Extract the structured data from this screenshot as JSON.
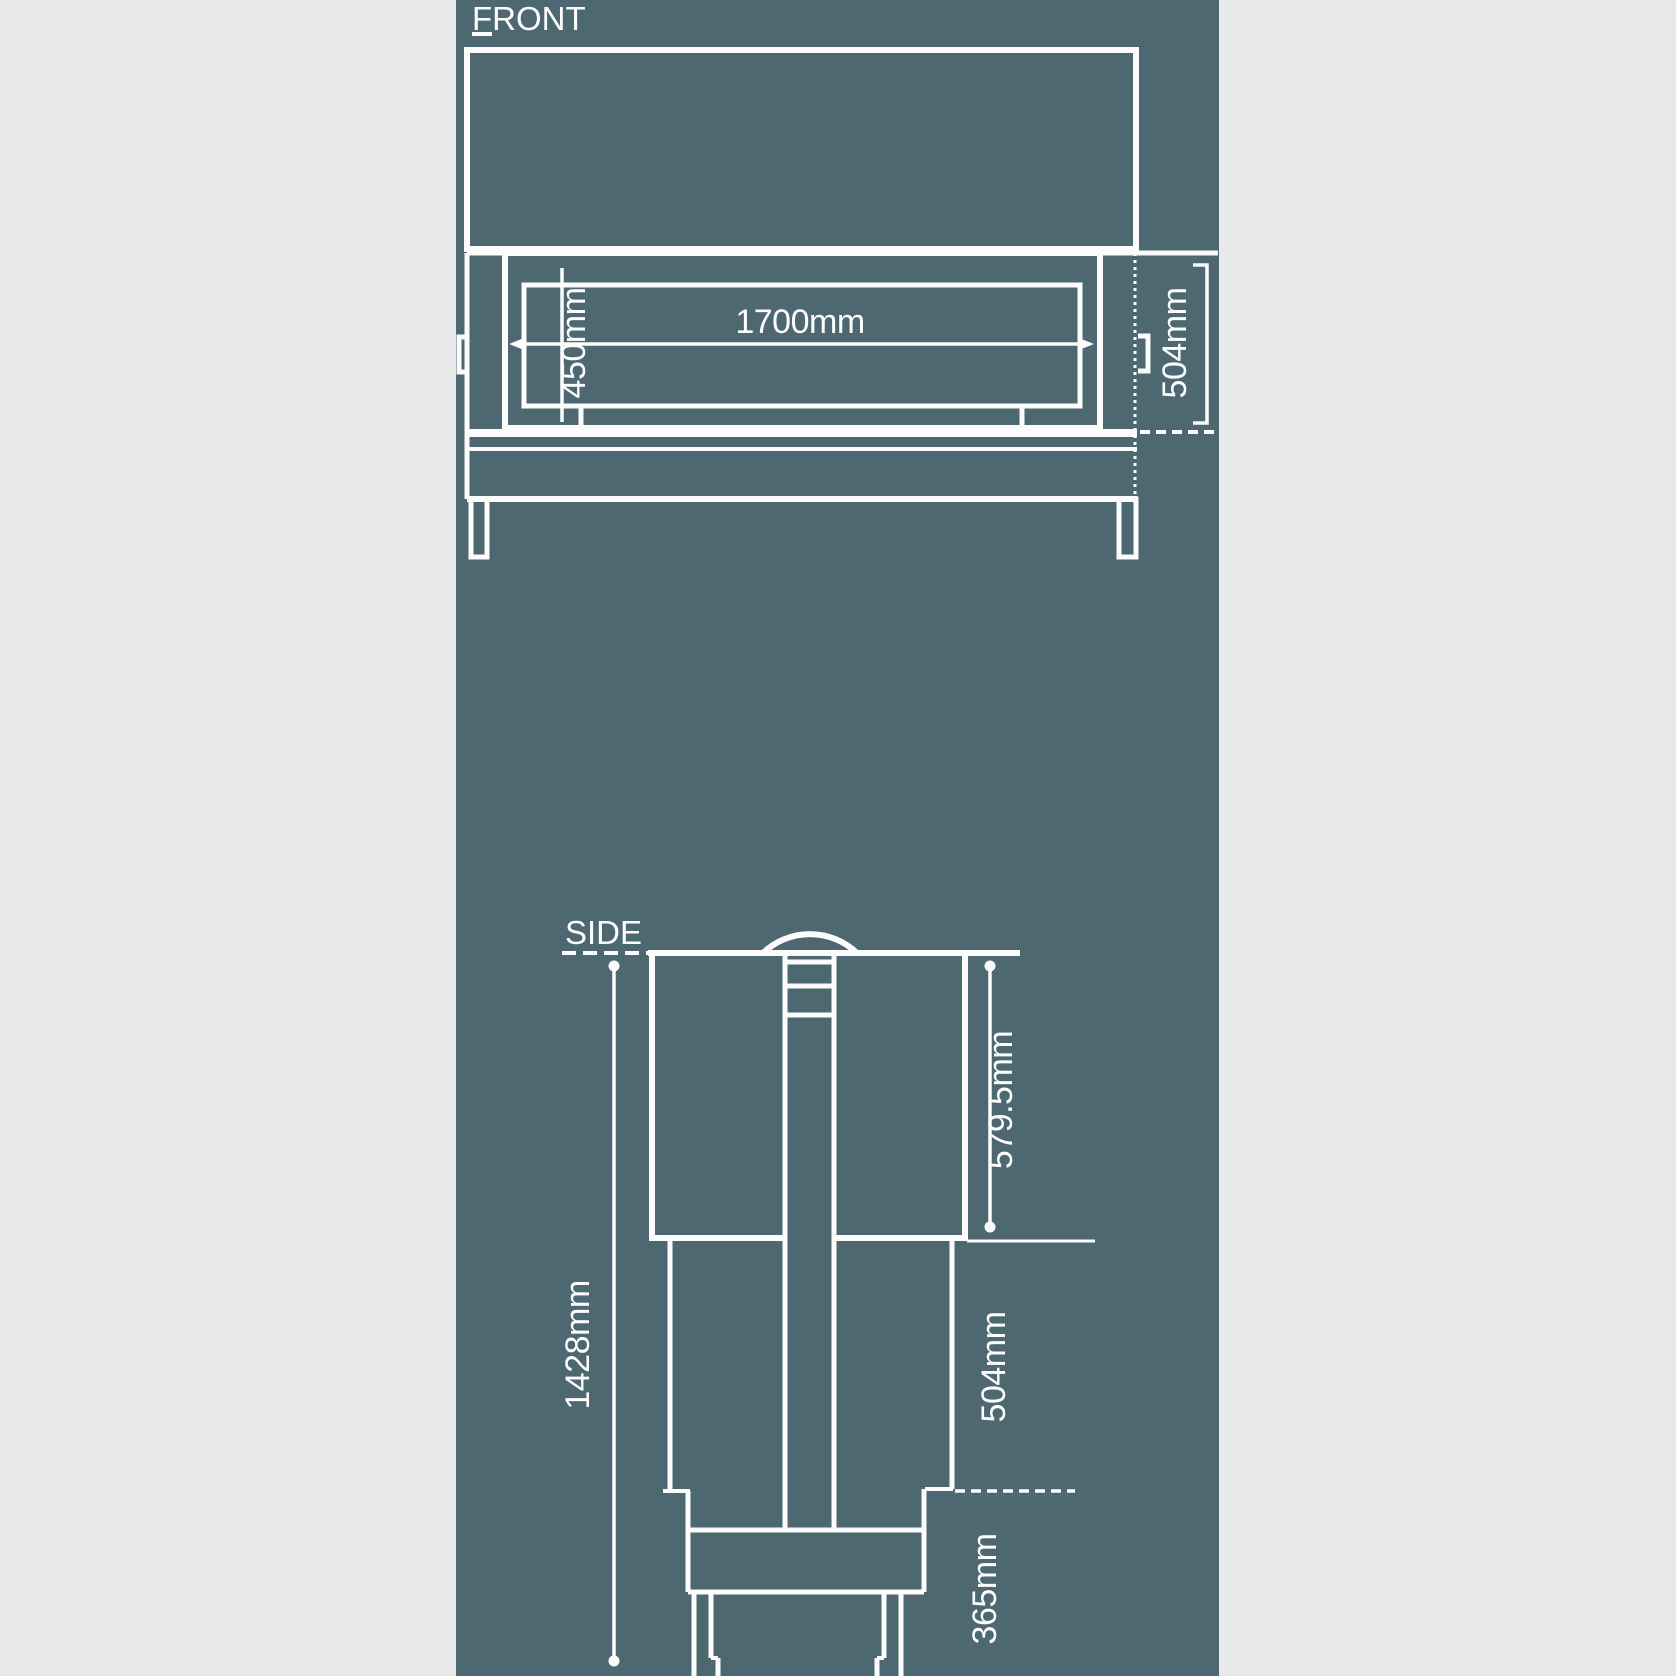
{
  "document": {
    "type": "technical-dimension-drawing"
  },
  "colors": {
    "canvas": "#e8e9ea",
    "panel": "#4d6871",
    "line": "#fcfcfd"
  },
  "front_view": {
    "label": "FRONT",
    "width_label": "1700mm",
    "opening_height_label": "450mm",
    "depth_label": "504mm"
  },
  "side_view": {
    "label": "SIDE",
    "hood_height_label": "579.5mm",
    "middle_height_label": "504mm",
    "base_height_label": "365mm",
    "overall_height_label": "1428mm"
  }
}
